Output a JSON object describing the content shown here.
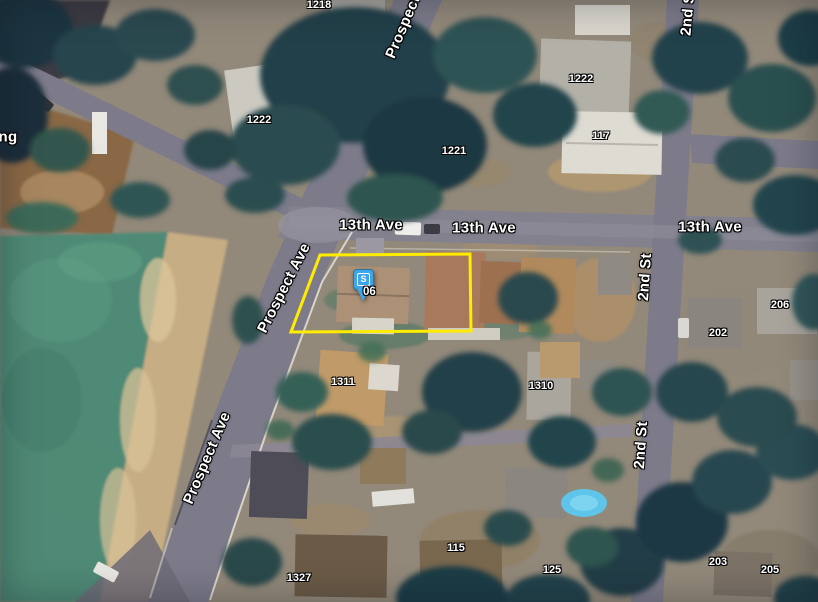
{
  "map": {
    "view": "satellite",
    "description": "Aerial neighborhood view at 13th Ave, Prospect Ave and 2nd St with highlighted parcel",
    "colors": {
      "parcel_outline": "#ffec00",
      "marker_blue": "#3da5e8",
      "road": "#7d7b8a",
      "road_light": "#8f8d9a",
      "field_green": "#4f8a76",
      "dirt_tan": "#c7ad83",
      "tree_dark": "#223c46"
    },
    "marker": {
      "label": "S",
      "sublabel": "06",
      "x": 353,
      "y": 269,
      "sub_x": 363,
      "sub_y": 286
    },
    "parcel": {
      "points": "320,255 470,254 471,331 291,332"
    },
    "street_labels": [
      {
        "text": "Prospect",
        "x": 403,
        "y": 27,
        "rot": -67
      },
      {
        "text": "13th Ave",
        "x": 371,
        "y": 225,
        "rot": 0
      },
      {
        "text": "13th Ave",
        "x": 484,
        "y": 228,
        "rot": 0
      },
      {
        "text": "13th Ave",
        "x": 710,
        "y": 227,
        "rot": 0
      },
      {
        "text": "2nd St",
        "x": 688,
        "y": 12,
        "rot": -85
      },
      {
        "text": "2nd St",
        "x": 645,
        "y": 277,
        "rot": -86
      },
      {
        "text": "2nd St",
        "x": 641,
        "y": 445,
        "rot": -86
      },
      {
        "text": "Prospect Ave",
        "x": 284,
        "y": 288,
        "rot": -63
      },
      {
        "text": "Prospect Ave",
        "x": 207,
        "y": 458,
        "rot": -67
      },
      {
        "text": "ng",
        "x": 8,
        "y": 137,
        "rot": 0
      }
    ],
    "house_numbers": [
      {
        "text": "1218",
        "x": 319,
        "y": 5
      },
      {
        "text": "1222",
        "x": 259,
        "y": 120
      },
      {
        "text": "1222",
        "x": 581,
        "y": 79
      },
      {
        "text": "1221",
        "x": 454,
        "y": 151
      },
      {
        "text": "117",
        "x": 601,
        "y": 136
      },
      {
        "text": "206",
        "x": 780,
        "y": 305
      },
      {
        "text": "202",
        "x": 718,
        "y": 333
      },
      {
        "text": "1311",
        "x": 343,
        "y": 382
      },
      {
        "text": "1310",
        "x": 541,
        "y": 386
      },
      {
        "text": "115",
        "x": 456,
        "y": 548
      },
      {
        "text": "125",
        "x": 552,
        "y": 570
      },
      {
        "text": "203",
        "x": 718,
        "y": 562
      },
      {
        "text": "205",
        "x": 770,
        "y": 570
      },
      {
        "text": "1327",
        "x": 299,
        "y": 578
      }
    ]
  }
}
